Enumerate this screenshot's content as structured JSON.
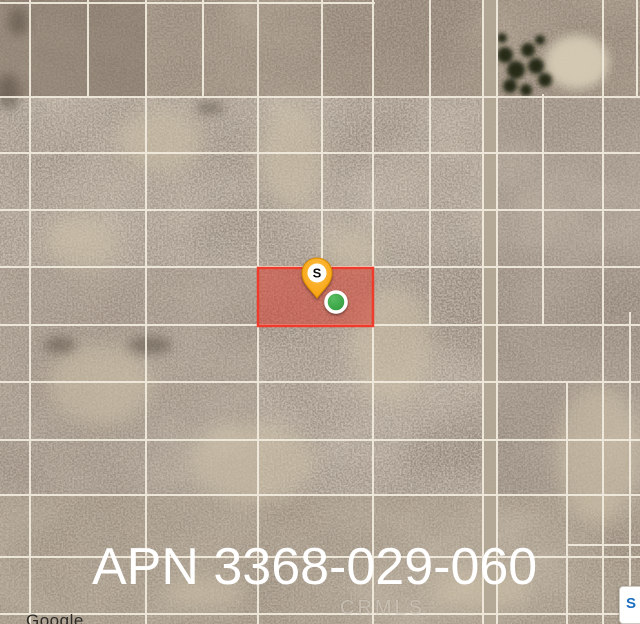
{
  "map": {
    "apn_label": "APN 3368-029-060",
    "watermark": "CRMLS",
    "attribution": "Google",
    "pin_letter": "S",
    "badge_letter": "S",
    "colors": {
      "parcel_fill": "rgba(217,62,48,0.52)",
      "parcel_border": "#ee3b2c",
      "pin_body": "#f7a01d",
      "pin_edge": "#d98a04",
      "pin_letter_bg": "#ffffff",
      "pin_letter_color": "#111111",
      "marker_green": "#2fa33c",
      "marker_ring": "#ffffff",
      "grid_line": "#f2ecdf",
      "road_fill": "#b3a795",
      "apn_text": "#ffffff"
    },
    "parcel": {
      "x": 258,
      "y": 268,
      "w": 115,
      "h": 58
    },
    "pin": {
      "x": 317,
      "y": 273
    },
    "marker": {
      "x": 336,
      "y": 302,
      "r": 10
    },
    "grid": {
      "h_lines": [
        {
          "y": 3,
          "x1": 0,
          "x2": 375
        },
        {
          "y": 97,
          "x1": 0,
          "x2": 640
        },
        {
          "y": 153,
          "x1": 0,
          "x2": 640
        },
        {
          "y": 210,
          "x1": 0,
          "x2": 640
        },
        {
          "y": 267,
          "x1": 0,
          "x2": 640
        },
        {
          "y": 325,
          "x1": 0,
          "x2": 640
        },
        {
          "y": 382,
          "x1": 0,
          "x2": 640
        },
        {
          "y": 440,
          "x1": 0,
          "x2": 640
        },
        {
          "y": 495,
          "x1": 0,
          "x2": 640
        },
        {
          "y": 545,
          "x1": 567,
          "x2": 640
        },
        {
          "y": 557,
          "x1": 0,
          "x2": 640
        },
        {
          "y": 614,
          "x1": 0,
          "x2": 640
        }
      ],
      "v_lines": [
        {
          "x": 30,
          "y1": 0,
          "y2": 624
        },
        {
          "x": 88,
          "y1": 0,
          "y2": 97
        },
        {
          "x": 146,
          "y1": 0,
          "y2": 624
        },
        {
          "x": 203,
          "y1": 0,
          "y2": 97
        },
        {
          "x": 258,
          "y1": 0,
          "y2": 624
        },
        {
          "x": 322,
          "y1": 0,
          "y2": 267
        },
        {
          "x": 373,
          "y1": 0,
          "y2": 624
        },
        {
          "x": 430,
          "y1": 0,
          "y2": 325
        },
        {
          "x": 483,
          "y1": 0,
          "y2": 624
        },
        {
          "x": 497,
          "y1": 0,
          "y2": 624
        },
        {
          "x": 543,
          "y1": 94,
          "y2": 325
        },
        {
          "x": 567,
          "y1": 382,
          "y2": 624
        },
        {
          "x": 603,
          "y1": 0,
          "y2": 624
        },
        {
          "x": 630,
          "y1": 312,
          "y2": 624
        },
        {
          "x": 637,
          "y1": 0,
          "y2": 97
        }
      ]
    }
  }
}
